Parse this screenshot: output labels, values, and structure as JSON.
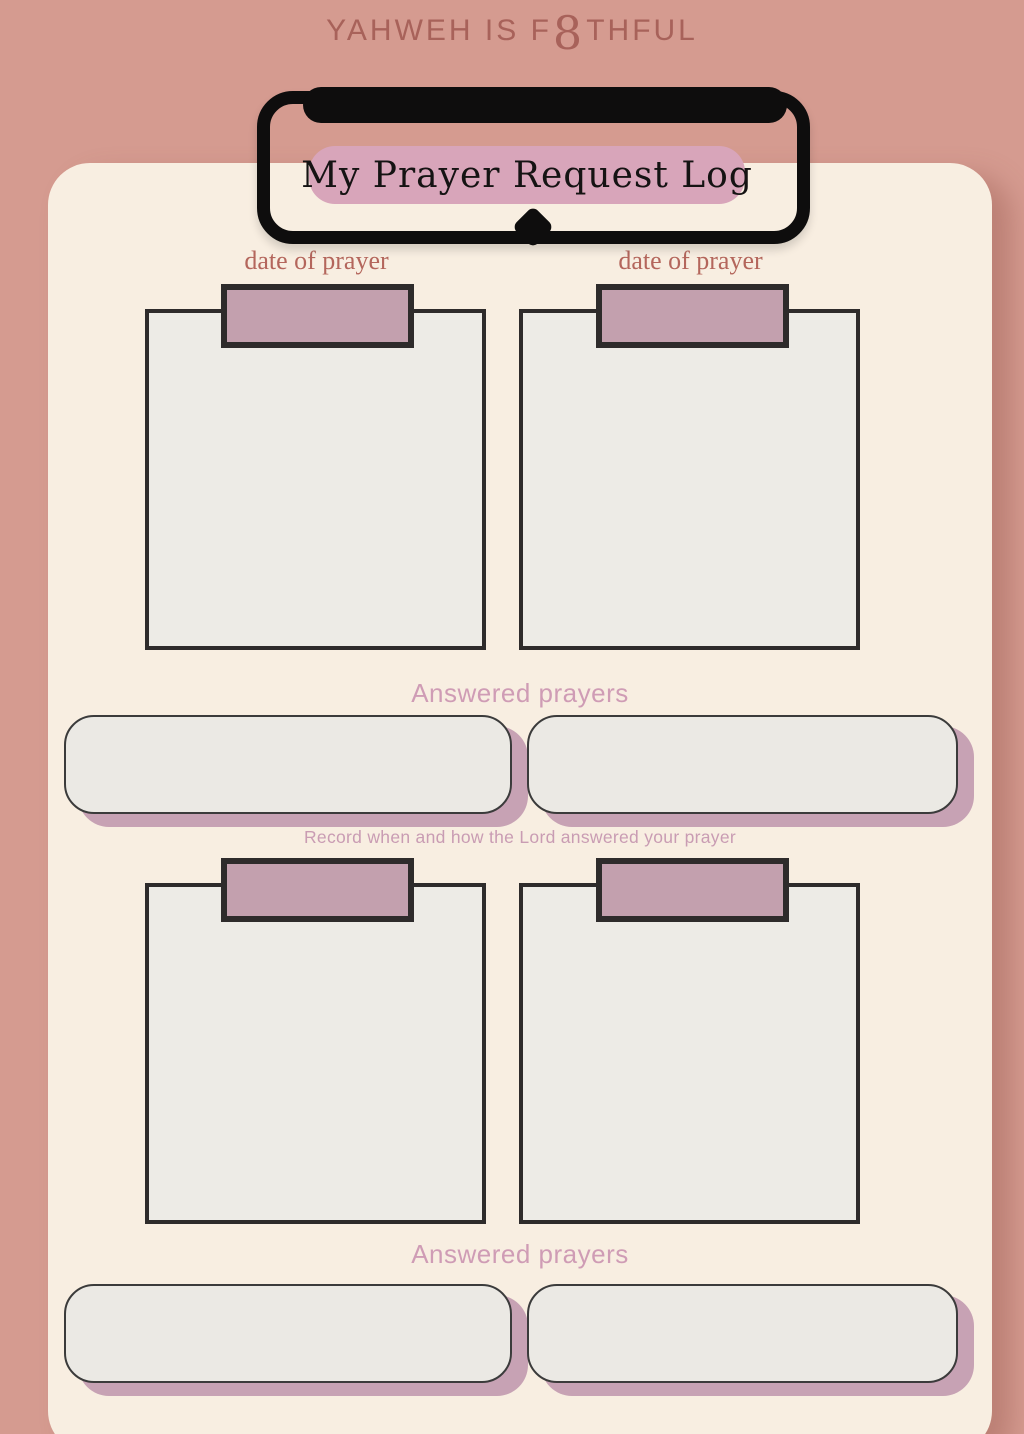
{
  "header": {
    "brand_prefix": "YAHWEH IS F",
    "brand_glyph": "8",
    "brand_suffix": "THFUL",
    "title": "My Prayer Request Log"
  },
  "top_section": {
    "date_label_left": "date of prayer",
    "date_label_right": "date of prayer",
    "answered_heading": "Answered prayers",
    "note": "Record when and how the Lord answered your prayer"
  },
  "bottom_section": {
    "answered_heading": "Answered prayers"
  },
  "colors": {
    "background": "#d59b90",
    "panel": "#f8eee1",
    "brand_text": "#a8625a",
    "clip_black": "#0e0d0d",
    "title_pill": "#d8a5ba",
    "title_text": "#151313",
    "date_label_text": "#b4665c",
    "tab_fill": "#c3a0ae",
    "box_border": "#2e2b2b",
    "box_fill": "#edebe6",
    "heading_pink": "#cf9cb5",
    "note_pink": "#c99cb3",
    "slot_fill": "#ebe9e4",
    "slot_shadow": "#c7a2b4"
  }
}
